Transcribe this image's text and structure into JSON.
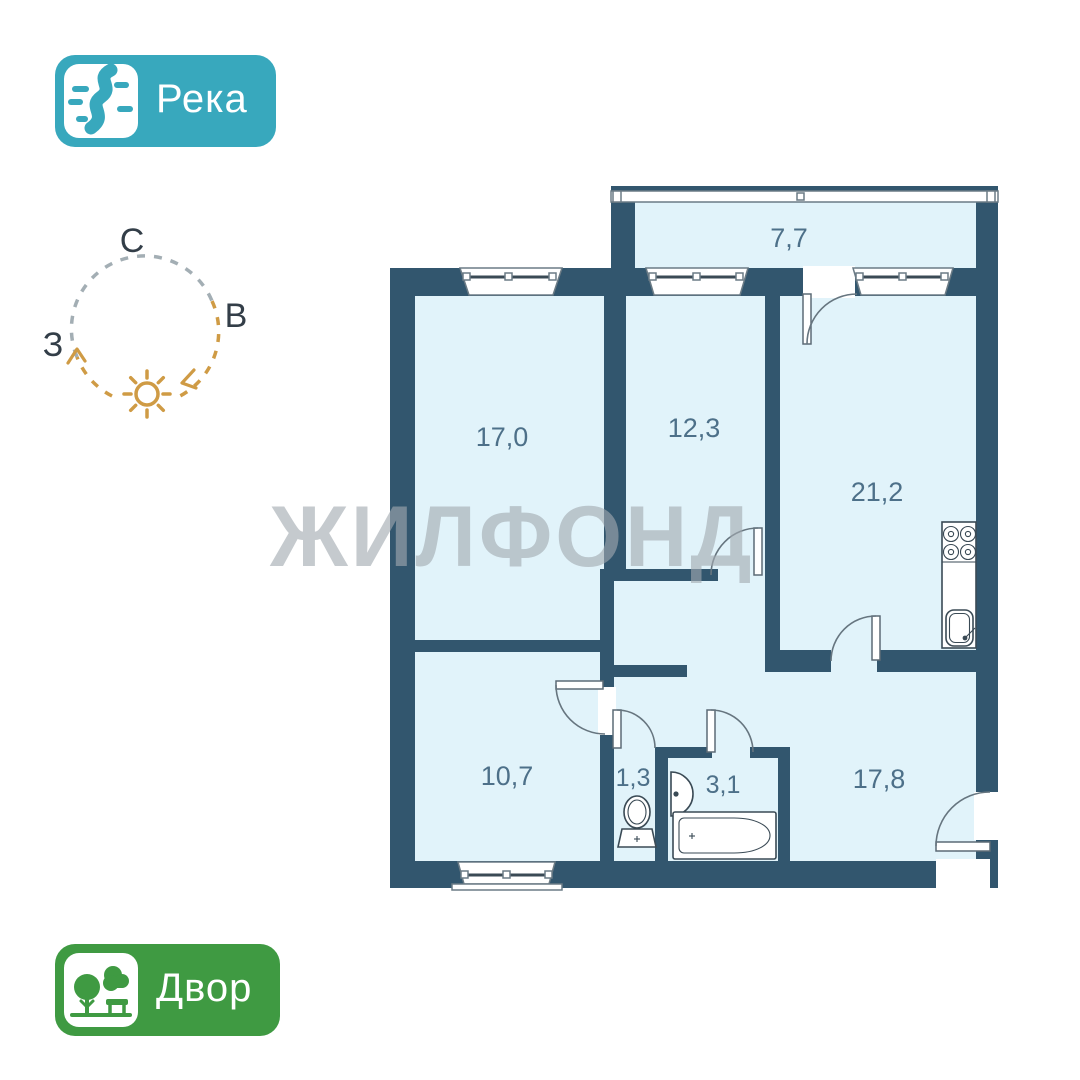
{
  "badges": {
    "river": {
      "label": "Река",
      "bg_color": "#38a8bd",
      "icon": "river-icon"
    },
    "yard": {
      "label": "Двор",
      "bg_color": "#3f9a42",
      "icon": "trees-icon"
    }
  },
  "compass": {
    "north_label": "С",
    "east_label": "В",
    "west_label": "З",
    "ring_color_north": "#a3aeb4",
    "sun_path_color": "#cf9b45"
  },
  "watermark": {
    "text": "ЖИЛФОНД"
  },
  "floor_plan": {
    "wall_color": "#32566e",
    "floor_color": "#e1f3fa",
    "label_color": "#4d7089",
    "rooms": [
      {
        "id": "balcony",
        "area": "7,7"
      },
      {
        "id": "room-top-left",
        "area": "17,0"
      },
      {
        "id": "room-top-middle",
        "area": "12,3"
      },
      {
        "id": "kitchen-living",
        "area": "21,2"
      },
      {
        "id": "room-bottom-left",
        "area": "10,7"
      },
      {
        "id": "wc",
        "area": "1,3"
      },
      {
        "id": "bathroom",
        "area": "3,1"
      },
      {
        "id": "hallway-living",
        "area": "17,8"
      }
    ]
  }
}
